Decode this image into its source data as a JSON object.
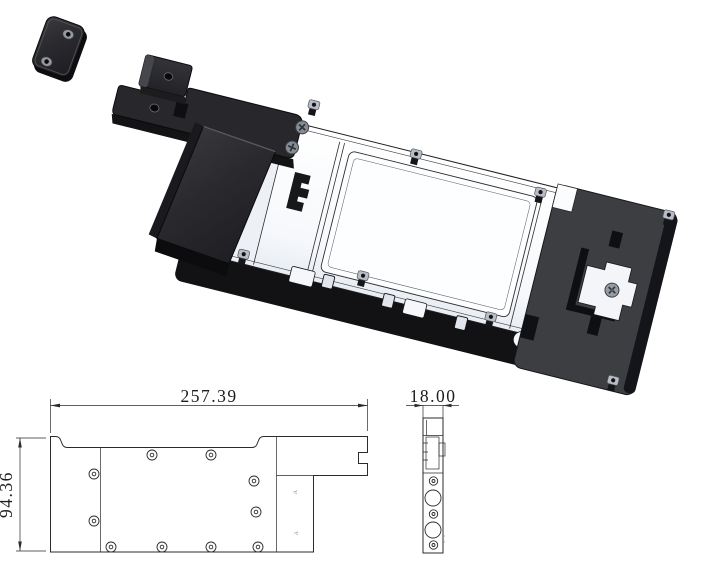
{
  "drawing": {
    "type": "mechanical-cad-drawing",
    "dimensions": {
      "overall_length": "257.39",
      "thickness": "18.00",
      "overall_height": "94.36"
    },
    "annotations": {
      "section_mark_upper": "A",
      "section_mark_lower": "A"
    },
    "colors": {
      "background": "#ffffff",
      "drawing_line": "#2b2b2b",
      "part_black": "#28282c",
      "part_black_dark": "#121214",
      "end_plate_gray": "#3d3e42",
      "plate_white": "#fbfcfe",
      "standoff_gray": "#b8bdc5"
    }
  }
}
